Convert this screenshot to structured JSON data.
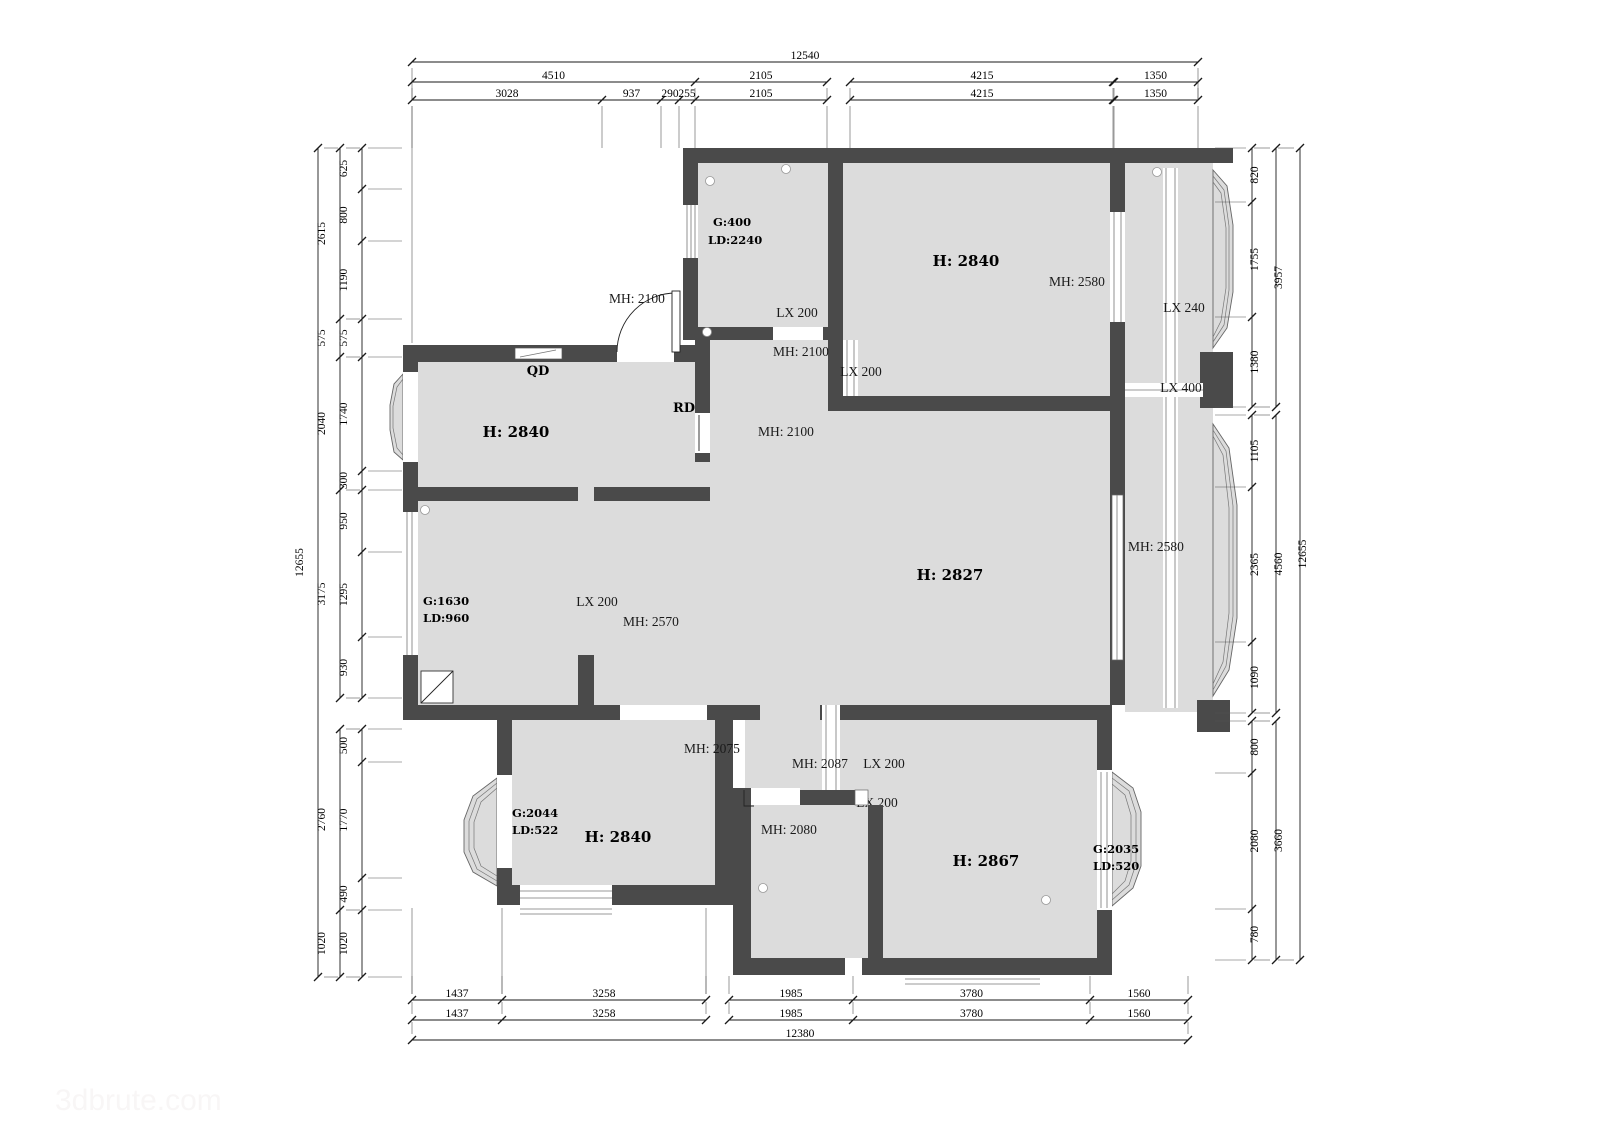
{
  "dims": {
    "top": {
      "total": [
        "12540"
      ],
      "row2": [
        "4510",
        "2105",
        "4215",
        "1350"
      ],
      "row3": [
        "3028",
        "937",
        "290",
        "255",
        "2105",
        "4215",
        "1350"
      ]
    },
    "bottom": {
      "row1": [
        "1437",
        "3258",
        "1985",
        "3780",
        "1560"
      ],
      "row2": [
        "1437",
        "3258",
        "1985",
        "3780",
        "1560"
      ],
      "total": [
        "12380"
      ]
    },
    "left": {
      "inner": [
        "625",
        "800",
        "1190",
        "575",
        "1740",
        "300",
        "950",
        "1295",
        "930",
        "500",
        "1770",
        "490",
        "1020"
      ],
      "mid": [
        "2615",
        "575",
        "2040",
        "3175",
        "2760",
        "1020"
      ],
      "total": [
        "12655"
      ]
    },
    "right": {
      "inner": [
        "820",
        "1755",
        "1380",
        "1105",
        "2365",
        "1090",
        "800",
        "2080",
        "780"
      ],
      "mid": [
        "3957",
        "4560",
        "3660"
      ],
      "total": [
        "12655"
      ]
    }
  },
  "labels": {
    "storage_g": "G:400",
    "storage_ld": "LD:2240",
    "storage_lx": "LX 200",
    "entry_mh": "MH: 2100",
    "storage_door_mh": "MH: 2100",
    "entry_lx": "LX 200",
    "bedroom_tr_h": "H: 2840",
    "bedroom_tr_mh": "MH: 2580",
    "corridor_lx240": "LX 240",
    "corridor_lx400": "LX 400",
    "qd": "QD",
    "rd": "RD",
    "living_h": "H: 2840",
    "hall_mh": "MH: 2100",
    "bedroom_ml_g": "G:1630",
    "bedroom_ml_ld": "LD:960",
    "bedroom_ml_lx": "LX 200",
    "bedroom_ml_mh": "MH: 2570",
    "hall_h": "H: 2827",
    "hall_right_mh": "MH: 2580",
    "bl_door_mh": "MH: 2075",
    "pass_mh": "MH: 2087",
    "pass_lx": "LX 200",
    "pass_lx2": "LX 200",
    "mid_room_mh": "MH: 2080",
    "bl_g": "G:2044",
    "bl_ld": "LD:522",
    "bl_h": "H: 2840",
    "br_h": "H: 2867",
    "br_g": "G:2035",
    "br_ld": "LD:520"
  },
  "watermark": "3dbrute.com",
  "colors": {
    "wall": "#4a4a4a",
    "floor": "#dcdcdc",
    "line": "#1a1a1a"
  }
}
